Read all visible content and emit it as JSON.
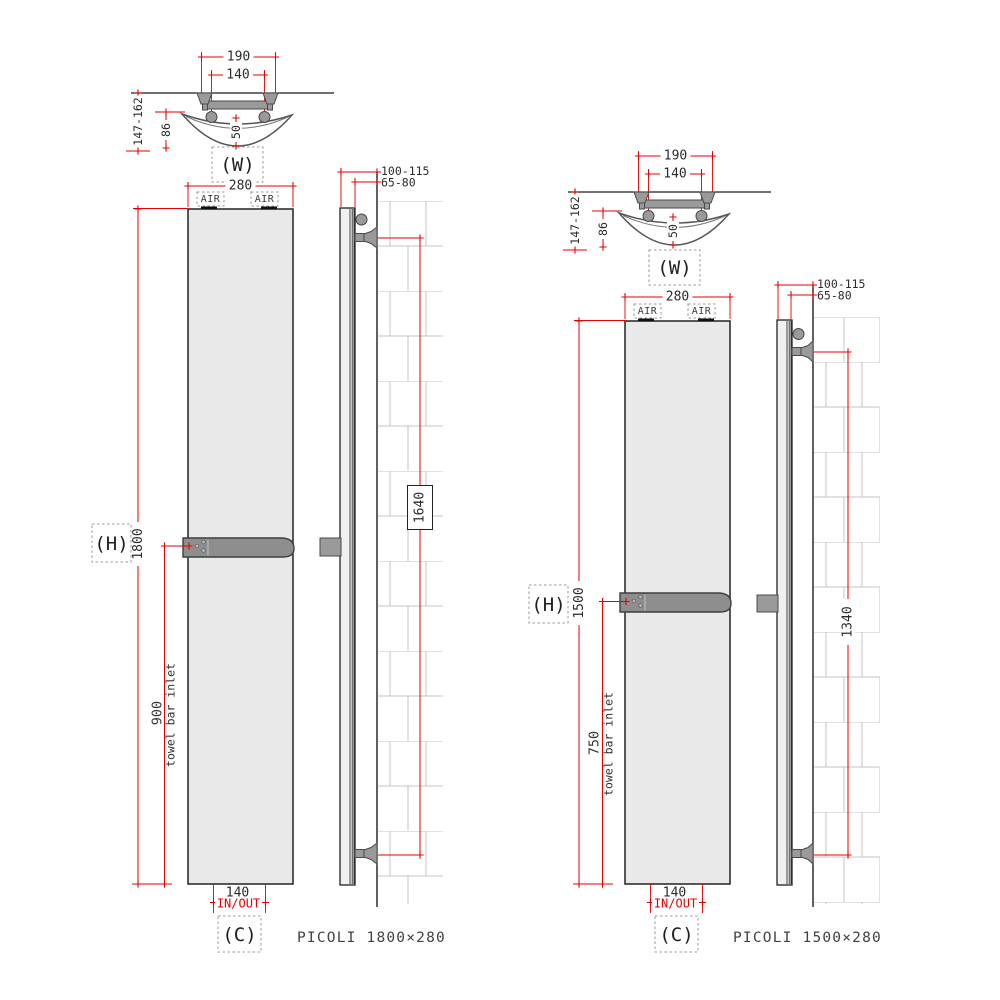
{
  "colors": {
    "dimension_red": "#e40000",
    "line_black": "#1c1c1c",
    "panel_fill": "#e9e9e9",
    "metal_gray": "#9a9a9a",
    "towel_bar_gray": "#8e8e8e",
    "brick_line": "#c6c6c6"
  },
  "diagrams": [
    {
      "id": "picoli-1800x280",
      "caption": "PICOLI 1800×280",
      "top_view": {
        "view_label": "(W)",
        "dim_bracket_outer": "190",
        "dim_bracket_inner": "140",
        "dim_depth_range": "147-162",
        "dim_pipe_depth": "86",
        "dim_curve_depth": "50"
      },
      "front_view": {
        "dim_width": "280",
        "air_vent_left": "AIR",
        "air_vent_right": "AIR",
        "height_ref_label": "(H)",
        "dim_height": "1800",
        "dim_towel_bar_height": "900",
        "towel_bar_note": "towel bar inlet",
        "dim_connection_spacing": "140",
        "connection_label": "IN/OUT",
        "connection_ref_label": "(C)"
      },
      "side_view": {
        "dim_wall_to_front": "100-115",
        "dim_wall_to_back": "65-80",
        "dim_bracket_centres": "1640"
      }
    },
    {
      "id": "picoli-1500x280",
      "caption": "PICOLI 1500×280",
      "top_view": {
        "view_label": "(W)",
        "dim_bracket_outer": "190",
        "dim_bracket_inner": "140",
        "dim_depth_range": "147-162",
        "dim_pipe_depth": "86",
        "dim_curve_depth": "50"
      },
      "front_view": {
        "dim_width": "280",
        "air_vent_left": "AIR",
        "air_vent_right": "AIR",
        "height_ref_label": "(H)",
        "dim_height": "1500",
        "dim_towel_bar_height": "750",
        "towel_bar_note": "towel bar inlet",
        "dim_connection_spacing": "140",
        "connection_label": "IN/OUT",
        "connection_ref_label": "(C)"
      },
      "side_view": {
        "dim_wall_to_front": "100-115",
        "dim_wall_to_back": "65-80",
        "dim_bracket_centres": "1340"
      }
    }
  ]
}
